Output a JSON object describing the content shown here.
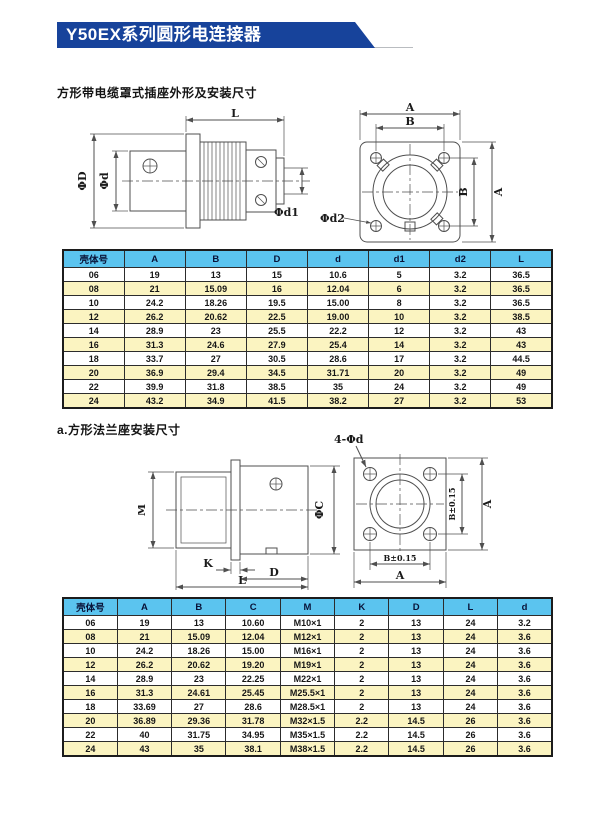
{
  "page": {
    "title": "Y50EX系列圆形电连接器"
  },
  "colors": {
    "banner_blue": "#17439b",
    "table_header_blue": "#5bc4ef",
    "table_row_alt_yellow": "#fbf4c1",
    "drawing_line_gray": "#4f4f4f"
  },
  "diagrams": {
    "plug_side": {
      "L": "L",
      "D": "ΦD",
      "d": "Φd",
      "d1": "Φd1"
    },
    "plug_front": {
      "A_top": "A",
      "B_top": "B",
      "B_right": "B",
      "A_right": "A",
      "d2": "Φd2"
    },
    "receptacle_side": {
      "M": "M",
      "C": "ΦC",
      "K": "K",
      "D": "D",
      "L": "L"
    },
    "receptacle_front": {
      "holes": "4-Φd",
      "B_right": "B±0.15",
      "A_right": "A",
      "B_bottom": "B±0.15",
      "A_bottom": "A"
    }
  },
  "section1": {
    "heading": "方形带电缆罩式插座外形及安装尺寸",
    "table": {
      "headers": [
        "壳体号",
        "A",
        "B",
        "D",
        "d",
        "d1",
        "d2",
        "L"
      ],
      "rows": [
        [
          "06",
          "19",
          "13",
          "15",
          "10.6",
          "5",
          "3.2",
          "36.5"
        ],
        [
          "08",
          "21",
          "15.09",
          "16",
          "12.04",
          "6",
          "3.2",
          "36.5"
        ],
        [
          "10",
          "24.2",
          "18.26",
          "19.5",
          "15.00",
          "8",
          "3.2",
          "36.5"
        ],
        [
          "12",
          "26.2",
          "20.62",
          "22.5",
          "19.00",
          "10",
          "3.2",
          "38.5"
        ],
        [
          "14",
          "28.9",
          "23",
          "25.5",
          "22.2",
          "12",
          "3.2",
          "43"
        ],
        [
          "16",
          "31.3",
          "24.6",
          "27.9",
          "25.4",
          "14",
          "3.2",
          "43"
        ],
        [
          "18",
          "33.7",
          "27",
          "30.5",
          "28.6",
          "17",
          "3.2",
          "44.5"
        ],
        [
          "20",
          "36.9",
          "29.4",
          "34.5",
          "31.71",
          "20",
          "3.2",
          "49"
        ],
        [
          "22",
          "39.9",
          "31.8",
          "38.5",
          "35",
          "24",
          "3.2",
          "49"
        ],
        [
          "24",
          "43.2",
          "34.9",
          "41.5",
          "38.2",
          "27",
          "3.2",
          "53"
        ]
      ]
    }
  },
  "section2": {
    "heading": "a.方形法兰座安装尺寸",
    "table": {
      "headers": [
        "壳体号",
        "A",
        "B",
        "C",
        "M",
        "K",
        "D",
        "L",
        "d"
      ],
      "rows": [
        [
          "06",
          "19",
          "13",
          "10.60",
          "M10×1",
          "2",
          "13",
          "24",
          "3.2"
        ],
        [
          "08",
          "21",
          "15.09",
          "12.04",
          "M12×1",
          "2",
          "13",
          "24",
          "3.6"
        ],
        [
          "10",
          "24.2",
          "18.26",
          "15.00",
          "M16×1",
          "2",
          "13",
          "24",
          "3.6"
        ],
        [
          "12",
          "26.2",
          "20.62",
          "19.20",
          "M19×1",
          "2",
          "13",
          "24",
          "3.6"
        ],
        [
          "14",
          "28.9",
          "23",
          "22.25",
          "M22×1",
          "2",
          "13",
          "24",
          "3.6"
        ],
        [
          "16",
          "31.3",
          "24.61",
          "25.45",
          "M25.5×1",
          "2",
          "13",
          "24",
          "3.6"
        ],
        [
          "18",
          "33.69",
          "27",
          "28.6",
          "M28.5×1",
          "2",
          "13",
          "24",
          "3.6"
        ],
        [
          "20",
          "36.89",
          "29.36",
          "31.78",
          "M32×1.5",
          "2.2",
          "14.5",
          "26",
          "3.6"
        ],
        [
          "22",
          "40",
          "31.75",
          "34.95",
          "M35×1.5",
          "2.2",
          "14.5",
          "26",
          "3.6"
        ],
        [
          "24",
          "43",
          "35",
          "38.1",
          "M38×1.5",
          "2.2",
          "14.5",
          "26",
          "3.6"
        ]
      ]
    }
  }
}
